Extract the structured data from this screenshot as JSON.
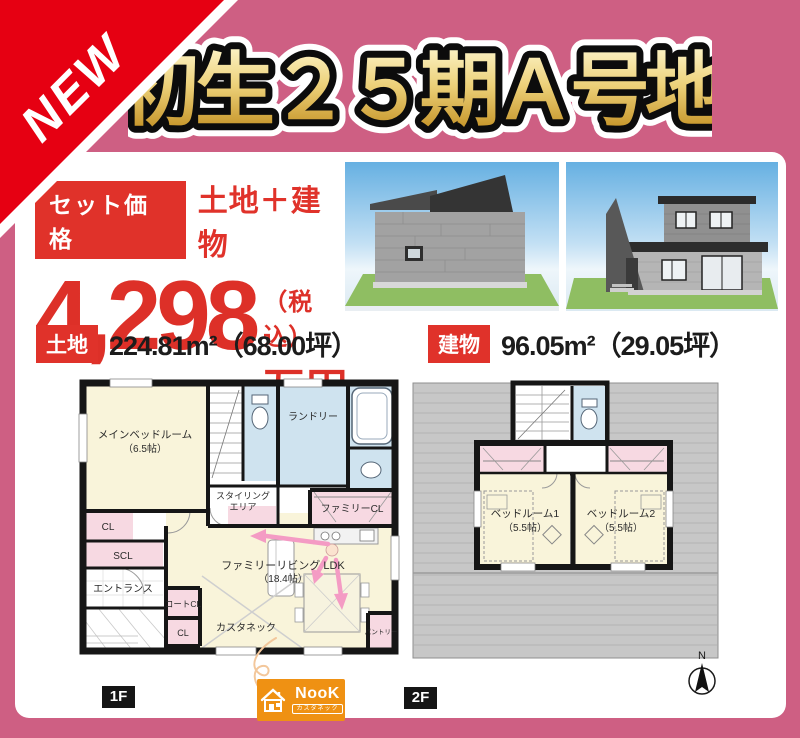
{
  "ribbon": {
    "label": "NEW"
  },
  "title": "初生２５期Ａ号地",
  "price": {
    "set_label": "セット価格",
    "composition": "土地＋建物",
    "amount": "4,298",
    "tax": "（税込）",
    "unit": "万円"
  },
  "areas": {
    "land_tag": "土地",
    "land_value": "224.81m²（68.00坪）",
    "building_tag": "建物",
    "building_value": "96.05m²（29.05坪）"
  },
  "plan1f": {
    "label": "1F",
    "main_bedroom": "メインベッドルーム",
    "main_bedroom_size": "（6.5帖）",
    "laundry": "ランドリー",
    "styling_1": "スタイリング",
    "styling_2": "エリア",
    "family_closet": "ファミリーCL",
    "closet_a": "CL",
    "shoes_closet": "SCL",
    "entrance": "エントランス",
    "coat_closet": "コートCL",
    "closet_b": "CL",
    "living": "ファミリーリビング LDK",
    "living_size": "（18.4帖）",
    "custom_space": "カスタネック",
    "pantry": "パントリー"
  },
  "plan2f": {
    "label": "2F",
    "bedroom1": "ベッドルーム1",
    "bedroom1_size": "（5.5帖）",
    "bedroom2": "ベッドルーム2",
    "bedroom2_size": "（5.5帖）"
  },
  "logo": {
    "brand": "NooK",
    "sub": "カスタネック"
  },
  "compass": {
    "north": "N"
  },
  "colors": {
    "background_pink": "#ce5f83",
    "ribbon_red": "#e60012",
    "accent_red": "#e0322a",
    "title_gold": "#d9a82c",
    "room_cream": "#f9f4da",
    "room_pink": "#f7d9e2",
    "room_blue": "#cfe3ef",
    "roof_gray": "#c7c7c7",
    "logo_orange": "#ef9113"
  }
}
